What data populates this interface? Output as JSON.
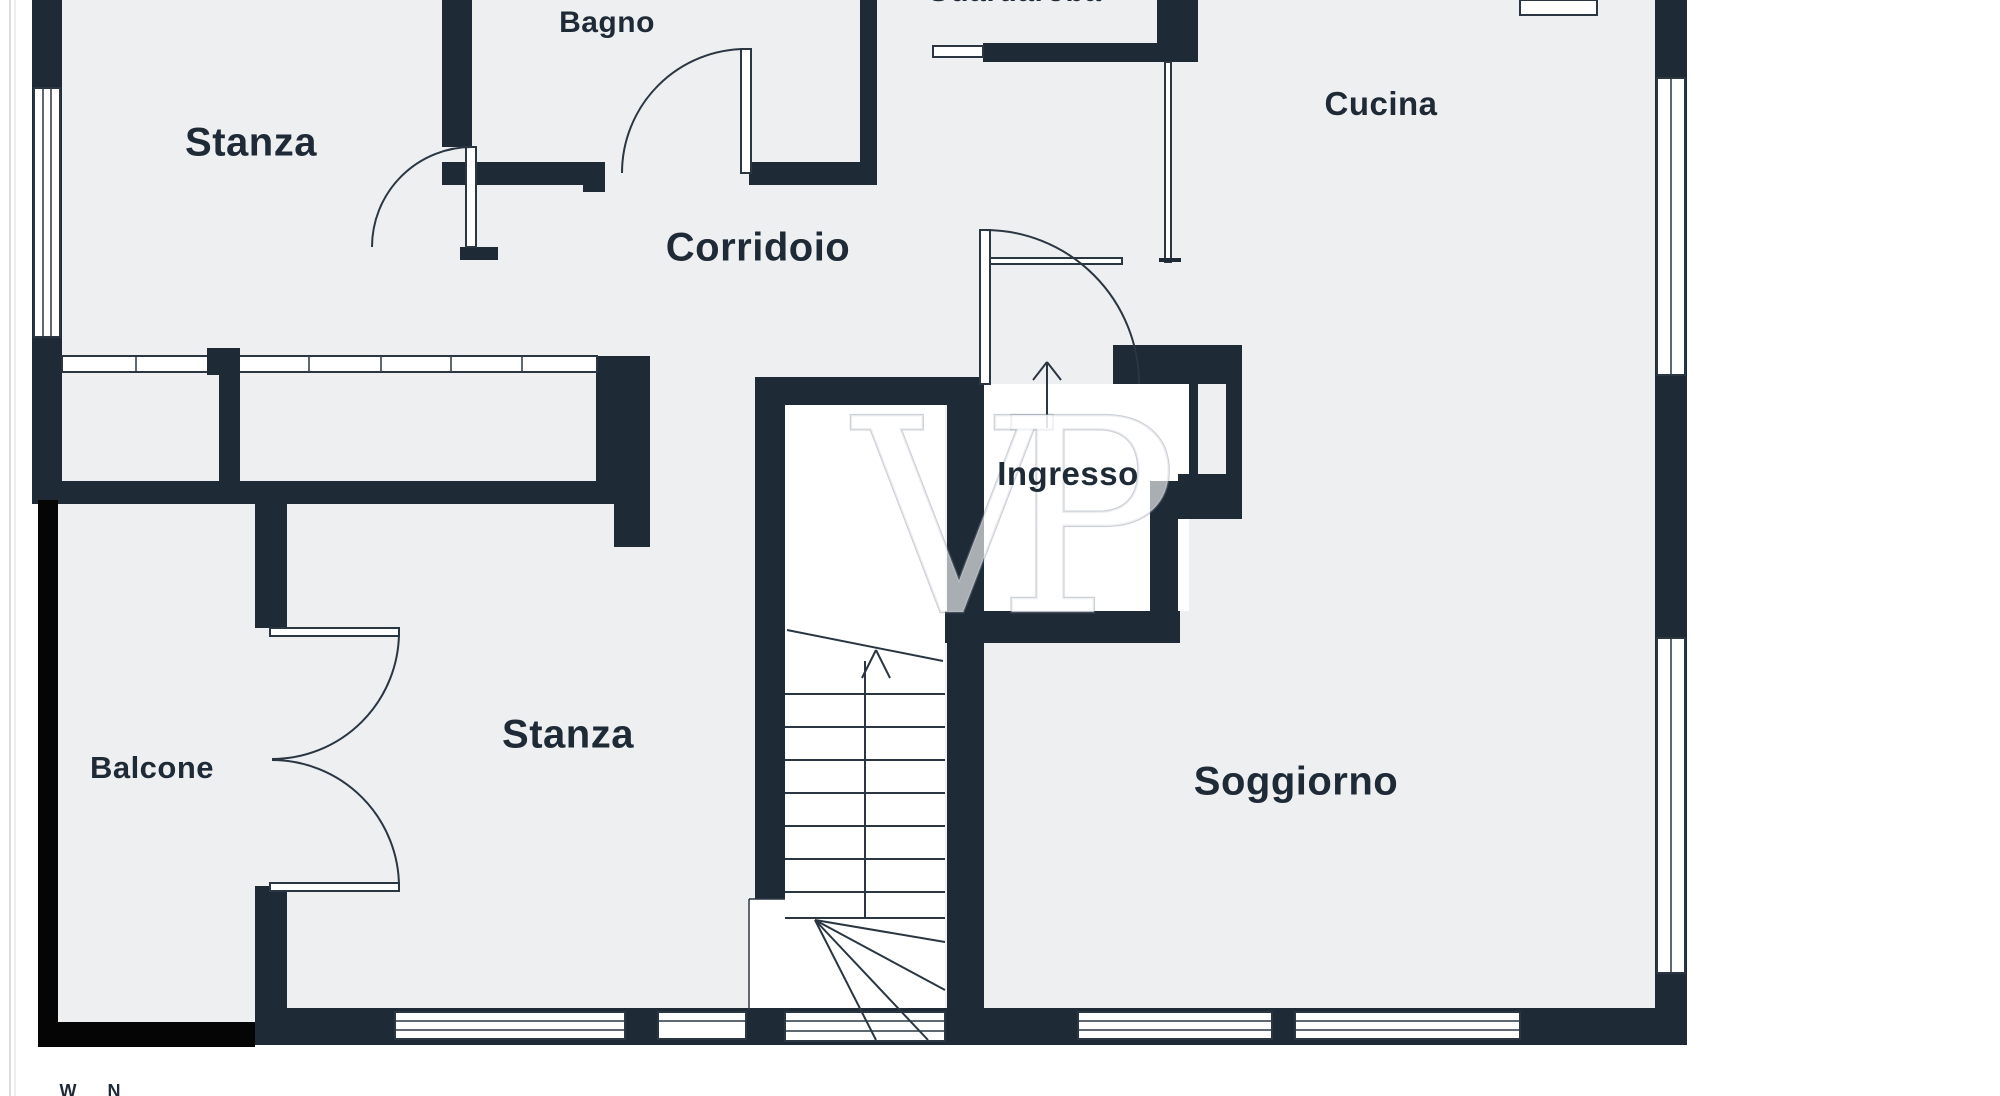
{
  "title": "Apartment floor plan",
  "colors": {
    "wall": "#1f2a37",
    "floor": "#edeff1",
    "balcony_wall": "#050505",
    "line": "#2a3642",
    "label": "#1f2a37",
    "page": "#ffffff",
    "edge_line": "#dcdcdc",
    "watermark_fill": "rgba(255,255,255,0.62)",
    "watermark_stroke": "rgba(125,138,152,0.38)"
  },
  "watermark": "VP",
  "rooms": [
    {
      "id": "stanza-top",
      "label": "Stanza"
    },
    {
      "id": "bagno",
      "label": "Bagno"
    },
    {
      "id": "corridoio",
      "label": "Corridoio"
    },
    {
      "id": "cucina",
      "label": "Cucina"
    },
    {
      "id": "ingresso",
      "label": "Ingresso"
    },
    {
      "id": "stanza-bottom",
      "label": "Stanza"
    },
    {
      "id": "balcone",
      "label": "Balcone"
    },
    {
      "id": "soggiorno",
      "label": "Soggiorno"
    }
  ],
  "partial_top_label": "Guardaroba",
  "compass": {
    "west": "W",
    "north": "N"
  }
}
